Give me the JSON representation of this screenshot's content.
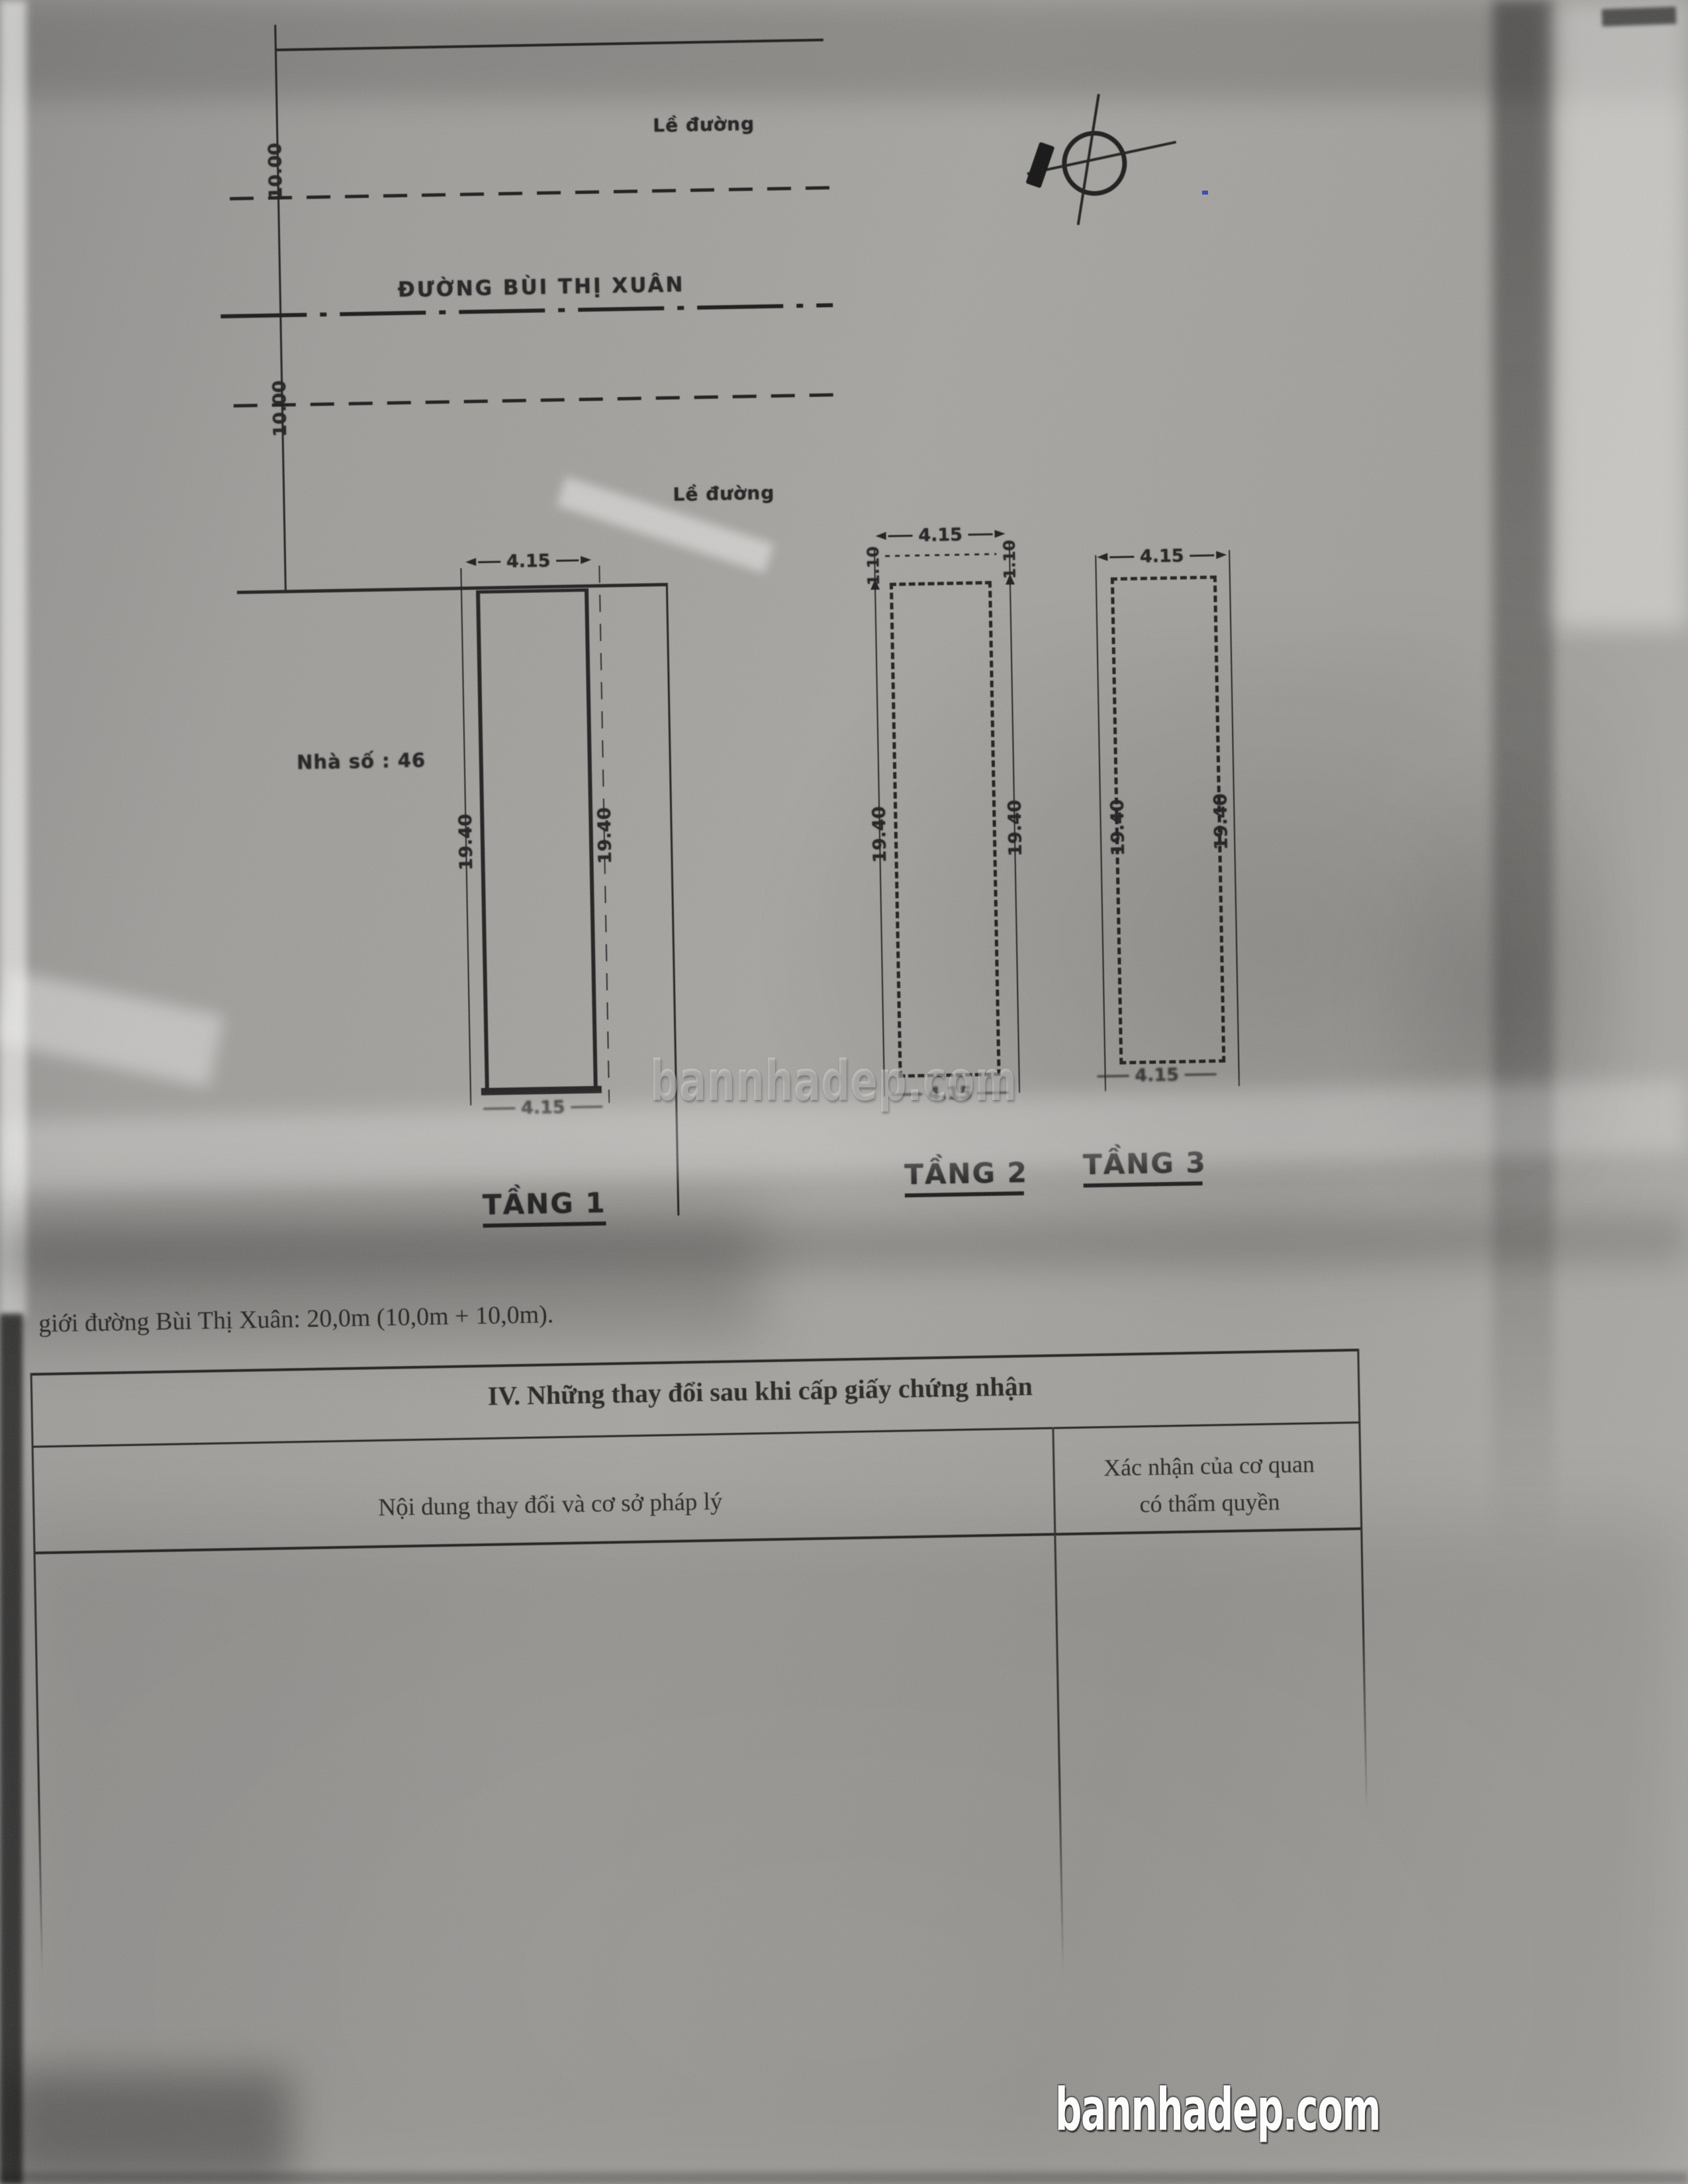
{
  "site_plan": {
    "sidewalk_label_top": "Lề đường",
    "street_name": "ĐƯỜNG BÙI THỊ XUÂN",
    "sidewalk_label_bottom": "Lề đường",
    "road_half_width_top": "10.00",
    "road_half_width_bottom": "10.00",
    "house_label": "Nhà số : 46",
    "north_symbol": "north-arrow-crosshair"
  },
  "floors": [
    {
      "name": "TẦNG 1",
      "width_top": "4.15",
      "width_bottom": "4.15",
      "depth_left": "19.40",
      "depth_right": "19.40"
    },
    {
      "name": "TẦNG 2",
      "width_top": "4.15",
      "width_bottom": "4.15",
      "depth_left": "19.40",
      "depth_right": "19.40",
      "offset_left": "1.10",
      "offset_right": "1.10"
    },
    {
      "name": "TẦNG 3",
      "width_top": "4.15",
      "width_bottom": "4.15",
      "depth_left": "19.40",
      "depth_right": "19.40"
    }
  ],
  "note": "giới đường Bùi Thị Xuân: 20,0m (10,0m + 10,0m).",
  "table": {
    "section_title": "IV. Những thay đổi sau khi cấp giấy chứng nhận",
    "col1_header": "Nội dung thay đổi và cơ sở pháp lý",
    "col2_header_line1": "Xác nhận của cơ quan",
    "col2_header_line2": "có thẩm quyền"
  },
  "watermark": {
    "center": "bannhadep.com",
    "corner": "bannhadep.com"
  },
  "colors": {
    "ink": "#1a1a1a",
    "paper": "#a2a09c",
    "watermark_corner": "#ffffff",
    "stray_dot": "#3344aa"
  }
}
